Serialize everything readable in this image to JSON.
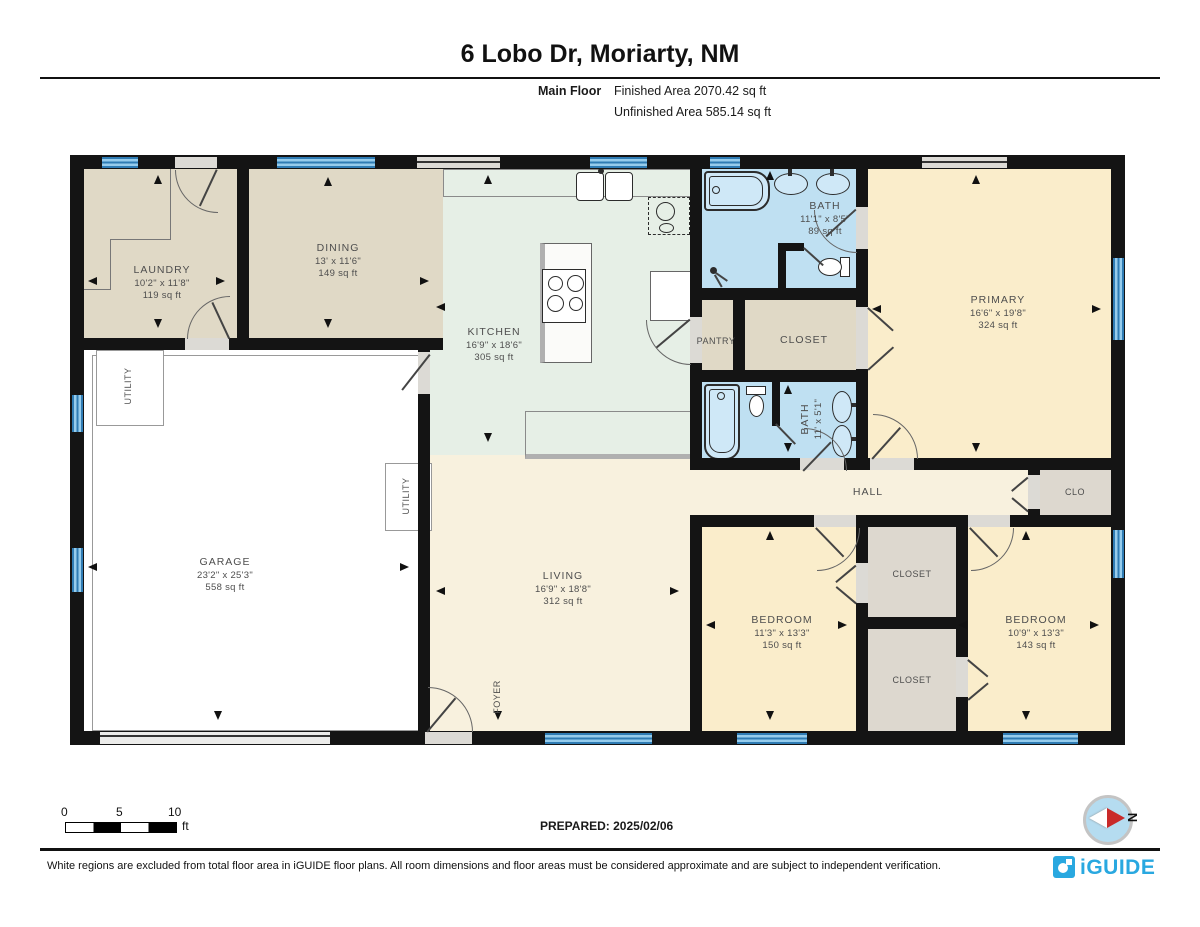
{
  "header": {
    "title": "6 Lobo Dr, Moriarty, NM",
    "floor_label": "Main Floor",
    "finished_area": "Finished Area 2070.42 sq ft",
    "unfinished_area": "Unfinished Area 585.14 sq ft"
  },
  "rooms": {
    "laundry": {
      "name": "LAUNDRY",
      "dims": "10'2\" x 11'8\"",
      "area": "119 sq ft"
    },
    "dining": {
      "name": "DINING",
      "dims": "13' x 11'6\"",
      "area": "149 sq ft"
    },
    "kitchen": {
      "name": "KITCHEN",
      "dims": "16'9\" x 18'6\"",
      "area": "305 sq ft"
    },
    "bath_main": {
      "name": "BATH",
      "dims": "11'1\" x 8'5\"",
      "area": "89 sq ft"
    },
    "primary": {
      "name": "PRIMARY",
      "dims": "16'6\" x 19'8\"",
      "area": "324 sq ft"
    },
    "pantry": {
      "name": "PANTRY"
    },
    "closet_primary": {
      "name": "CLOSET"
    },
    "bath_hall": {
      "name": "BATH",
      "dims": "11' x 5'1\""
    },
    "garage": {
      "name": "GARAGE",
      "dims": "23'2\" x 25'3\"",
      "area": "558 sq ft"
    },
    "utility_a": {
      "name": "UTILITY"
    },
    "utility_b": {
      "name": "UTILITY"
    },
    "living": {
      "name": "LIVING",
      "dims": "16'9\" x 18'8\"",
      "area": "312 sq ft"
    },
    "foyer": {
      "name": "FOYER"
    },
    "hall": {
      "name": "HALL"
    },
    "clo": {
      "name": "CLO"
    },
    "bedroom_a": {
      "name": "BEDROOM",
      "dims": "11'3\" x 13'3\"",
      "area": "150 sq ft"
    },
    "closet_a": {
      "name": "CLOSET"
    },
    "closet_b": {
      "name": "CLOSET"
    },
    "bedroom_b": {
      "name": "BEDROOM",
      "dims": "10'9\" x 13'3\"",
      "area": "143 sq ft"
    }
  },
  "scale_bar": {
    "tick_0": "0",
    "tick_5": "5",
    "tick_10": "10",
    "unit": "ft"
  },
  "prepared": "PREPARED: 2025/02/06",
  "compass": {
    "north_label": "N"
  },
  "footer": {
    "disclaimer": "White regions are excluded from total floor area in iGUIDE floor plans. All room dimensions and floor areas must be considered approximate and are subject to independent verification.",
    "brand": "iGUIDE"
  },
  "colors": {
    "wall": "#141414",
    "window_blue": "#2F7CB4",
    "bath_blue": "#BFE0F2",
    "brand_blue": "#29A8E0"
  }
}
